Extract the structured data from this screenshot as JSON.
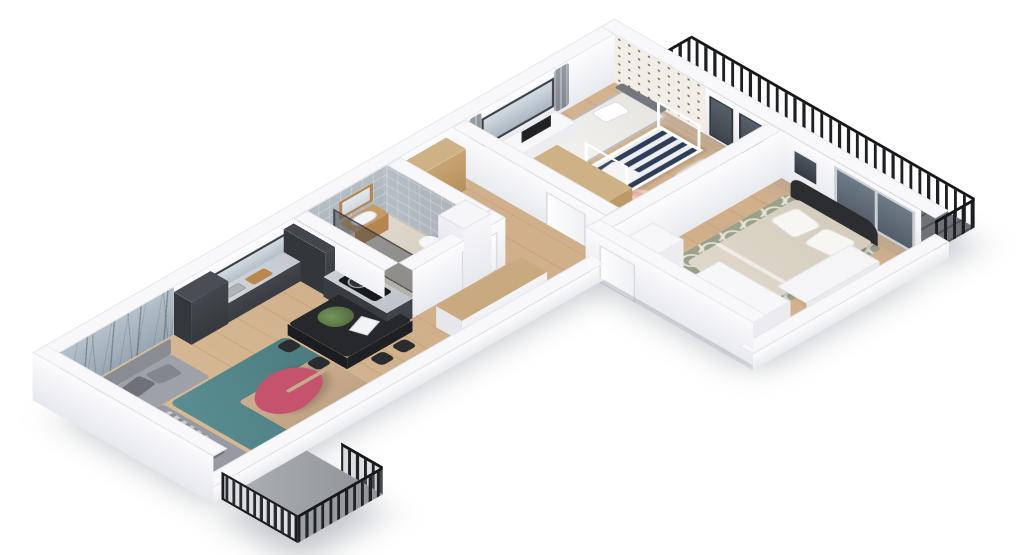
{
  "scene": {
    "description": "Isometric 3D rendering of an apartment floor plan on a white background, viewed from above at an angle. Open-plan living room with dark graphite kitchen, bathroom, hallway, nursery, master bedroom and two balconies with black metal railings.",
    "background_color": "#ffffff",
    "palette": {
      "wall_white": "#f8f8fb",
      "floor_wood": "#d2b490",
      "kitchen_cabinets": "#3b3f44",
      "countertop": "#ccd1d5",
      "forest_wallpaper": "#a5b4c0",
      "polka_wallpaper": "#f2ede5",
      "bath_tile": "#aeb6bd",
      "sofa_gray": "#9a9ca4",
      "rug_teal": "#4f8084",
      "rug_beige": "#c6a98b",
      "coffee_table_pink": "#c5536e",
      "dining_set_black": "#26282c",
      "desk_chair_yellow": "#d79b21",
      "crib_stripes_navy": "#2f3d58",
      "nursery_rug_pink": "#ecbcb3",
      "master_rug_green": "#99a18b",
      "bed_duvet_beige": "#dcd4c5",
      "headboard_black": "#2c2d30",
      "railing_black": "#1d1f22",
      "wardrobe_wood": "#c9aa7e"
    },
    "rooms": [
      {
        "name": "living-dining-kitchen",
        "features": [
          "forest-and-birds feature wallpaper",
          "L-shaped gray sectional sofa with cushions and striped throw",
          "teal and beige rug",
          "pink kidney-shaped coffee table",
          "black dining table with black chairs, plant and magazine",
          "dark graphite kitchen with tall units, window over counter, island leg with black hob"
        ]
      },
      {
        "name": "bathroom",
        "features": [
          "gray mosaic tiled walls",
          "walk-in shower with dark glass",
          "wood vanity with white sink",
          "wood framed mirror",
          "wall-hung toilet",
          "tall white service column"
        ]
      },
      {
        "name": "hallway-entry",
        "features": [
          "long low wardrobe with wood top",
          "tall wood wardrobe",
          "white interior doors"
        ]
      },
      {
        "name": "nursery",
        "features": [
          "polka-dot wallpaper end wall",
          "window with gray curtains",
          "white desk with monitor",
          "mustard yellow desk chair",
          "gray daybed with white bedding",
          "white house-frame crib with navy striped bedding",
          "round pink crochet rug",
          "beige armchair",
          "wood wardrobe",
          "two tall dark windows"
        ]
      },
      {
        "name": "master-bedroom",
        "features": [
          "double bed with beige duvet and black curved headboard",
          "white pillows",
          "green trellis patterned rug",
          "white wardrobe and dresser blocks",
          "dark sliding glass door to balcony",
          "small dark window"
        ]
      },
      {
        "name": "balcony-left",
        "features": [
          "black metal railing with light slats",
          "concrete floor"
        ]
      },
      {
        "name": "balcony-right",
        "features": [
          "long black metal railing",
          "dark decked floor"
        ]
      }
    ]
  }
}
